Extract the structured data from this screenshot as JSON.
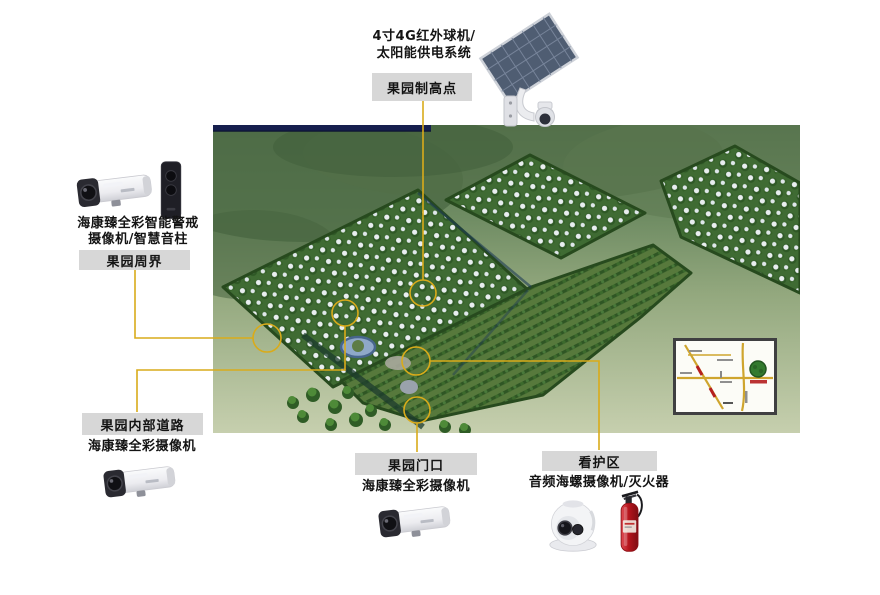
{
  "colors": {
    "label_bg": "#d7d7d7",
    "connector_line": "#d9ab1a",
    "device_text": "#141414",
    "aerial_topbar": "#161f4e"
  },
  "groups": {
    "highpoint": {
      "device_line1": "4寸4G红外球机/",
      "device_line2": "太阳能供电系统",
      "label": "果园制高点",
      "icon": "solar-panel-ptz-camera-icon"
    },
    "perimeter": {
      "device_line1": "海康臻全彩智能警戒",
      "device_line2": "摄像机/智慧音柱",
      "label": "果园周界",
      "icons": [
        "bullet-camera-icon",
        "smart-speaker-column-icon"
      ]
    },
    "internal_road": {
      "label": "果园内部道路",
      "device": "海康臻全彩摄像机",
      "icon": "bullet-camera-icon"
    },
    "gate": {
      "label": "果园门口",
      "device": "海康臻全彩摄像机",
      "icon": "bullet-camera-icon"
    },
    "care_area": {
      "label": "看护区",
      "device": "音频海螺摄像机/灭火器",
      "icons": [
        "turret-camera-icon",
        "fire-extinguisher-icon"
      ]
    }
  },
  "aerial": {
    "scene": "orchard-aerial-rendering",
    "inset": "road-map-inset"
  }
}
